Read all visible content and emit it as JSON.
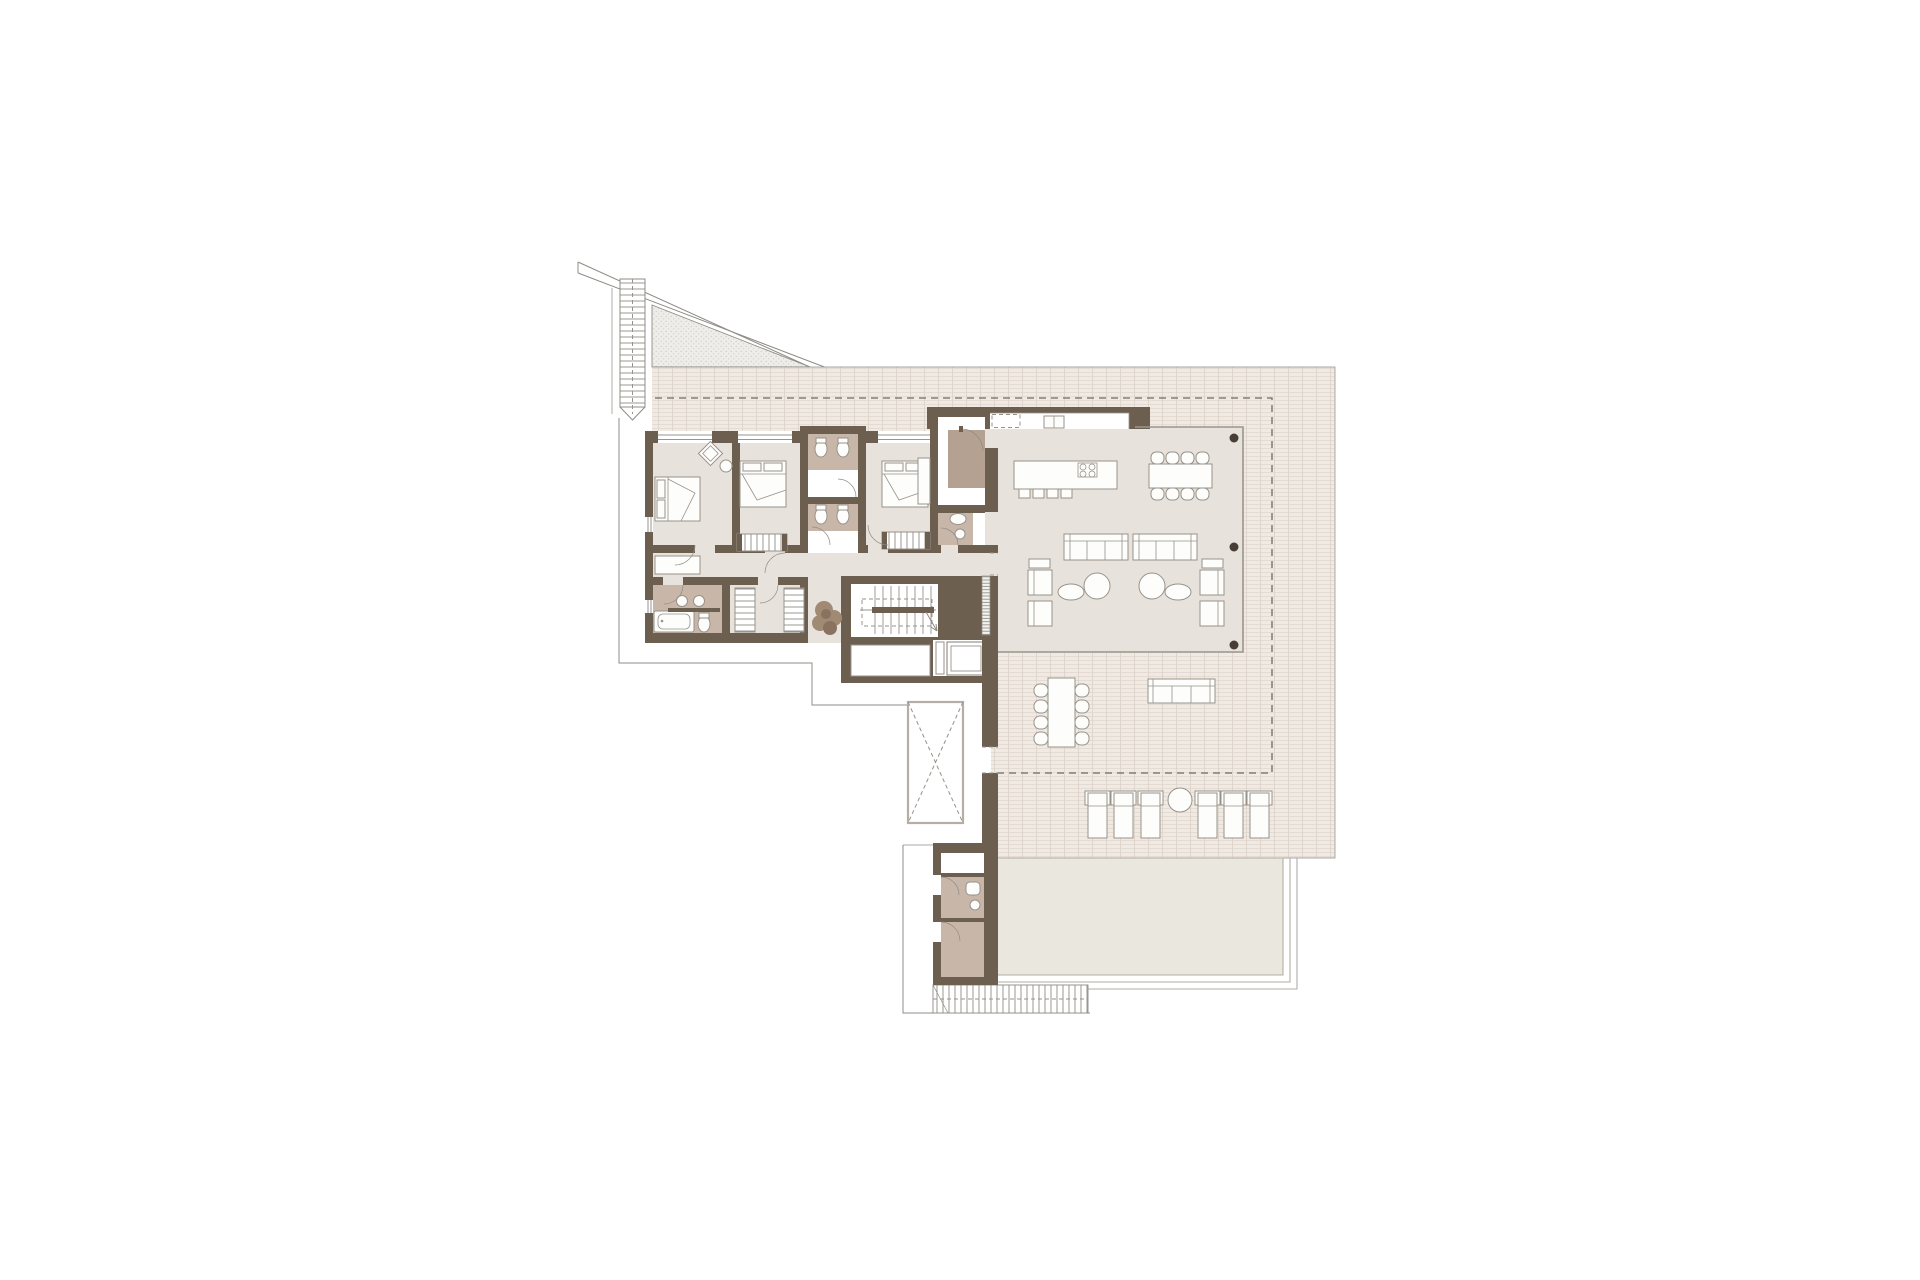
{
  "document": {
    "kind": "architectural floor plan",
    "storey": "upper floor of a villa with roof terrace and pool",
    "visible_text": "none"
  },
  "palette": {
    "paper": "#ffffff",
    "wall": "#6d5f50",
    "floor": "#e7e3dc",
    "bath_floor": "#c8b6a9",
    "closet_fill": "#b5a191",
    "tile_fill": "#f0eae3",
    "tile_line": "#dcd2c9",
    "pool_fill": "#eae7df",
    "pool_edge": "#b2aea5",
    "outline": "#8f8c86",
    "glass": "#9a958d",
    "furniture_fill": "#fdfdfb",
    "furniture_stroke": "#98928a",
    "dash_line": "#6b6a66",
    "column": "#473e35",
    "plant": "#a08a74",
    "plant_dark": "#8a7260",
    "stipple_fill": "#eeedea",
    "stipple_dot": "#cccbc4"
  },
  "rooms": [
    {
      "name": "bedroom-1"
    },
    {
      "name": "bedroom-2"
    },
    {
      "name": "bedroom-3"
    },
    {
      "name": "bathroom-a"
    },
    {
      "name": "bathroom-b"
    },
    {
      "name": "ensuite-bathroom"
    },
    {
      "name": "family-bathroom"
    },
    {
      "name": "dressing-closets"
    },
    {
      "name": "corridor"
    },
    {
      "name": "entry-hall"
    },
    {
      "name": "kitchen-living-dining"
    },
    {
      "name": "stair-core"
    },
    {
      "name": "elevator"
    },
    {
      "name": "storage"
    },
    {
      "name": "void-skylight"
    },
    {
      "name": "roof-terrace"
    },
    {
      "name": "outdoor-dining"
    },
    {
      "name": "lounge-deck"
    },
    {
      "name": "pool"
    },
    {
      "name": "pool-bathroom"
    },
    {
      "name": "pool-changing-room"
    },
    {
      "name": "exterior-stair"
    },
    {
      "name": "garden-steps"
    }
  ],
  "furniture_counts": {
    "double-beds": 3,
    "wardrobes": 4,
    "bathtub": 1,
    "showers": 3,
    "toilets": 7,
    "sinks": 5,
    "kitchen-island": 1,
    "bar-stools": 4,
    "dining-chairs-indoor": 8,
    "sofas-indoor": 2,
    "armchairs": 4,
    "coffee-tables": 2,
    "outdoor-dining-chairs": 8,
    "outdoor-sofa": 1,
    "sun-loungers": 6,
    "outdoor-side-table": 1,
    "structural-columns": 3,
    "planter": 1
  }
}
